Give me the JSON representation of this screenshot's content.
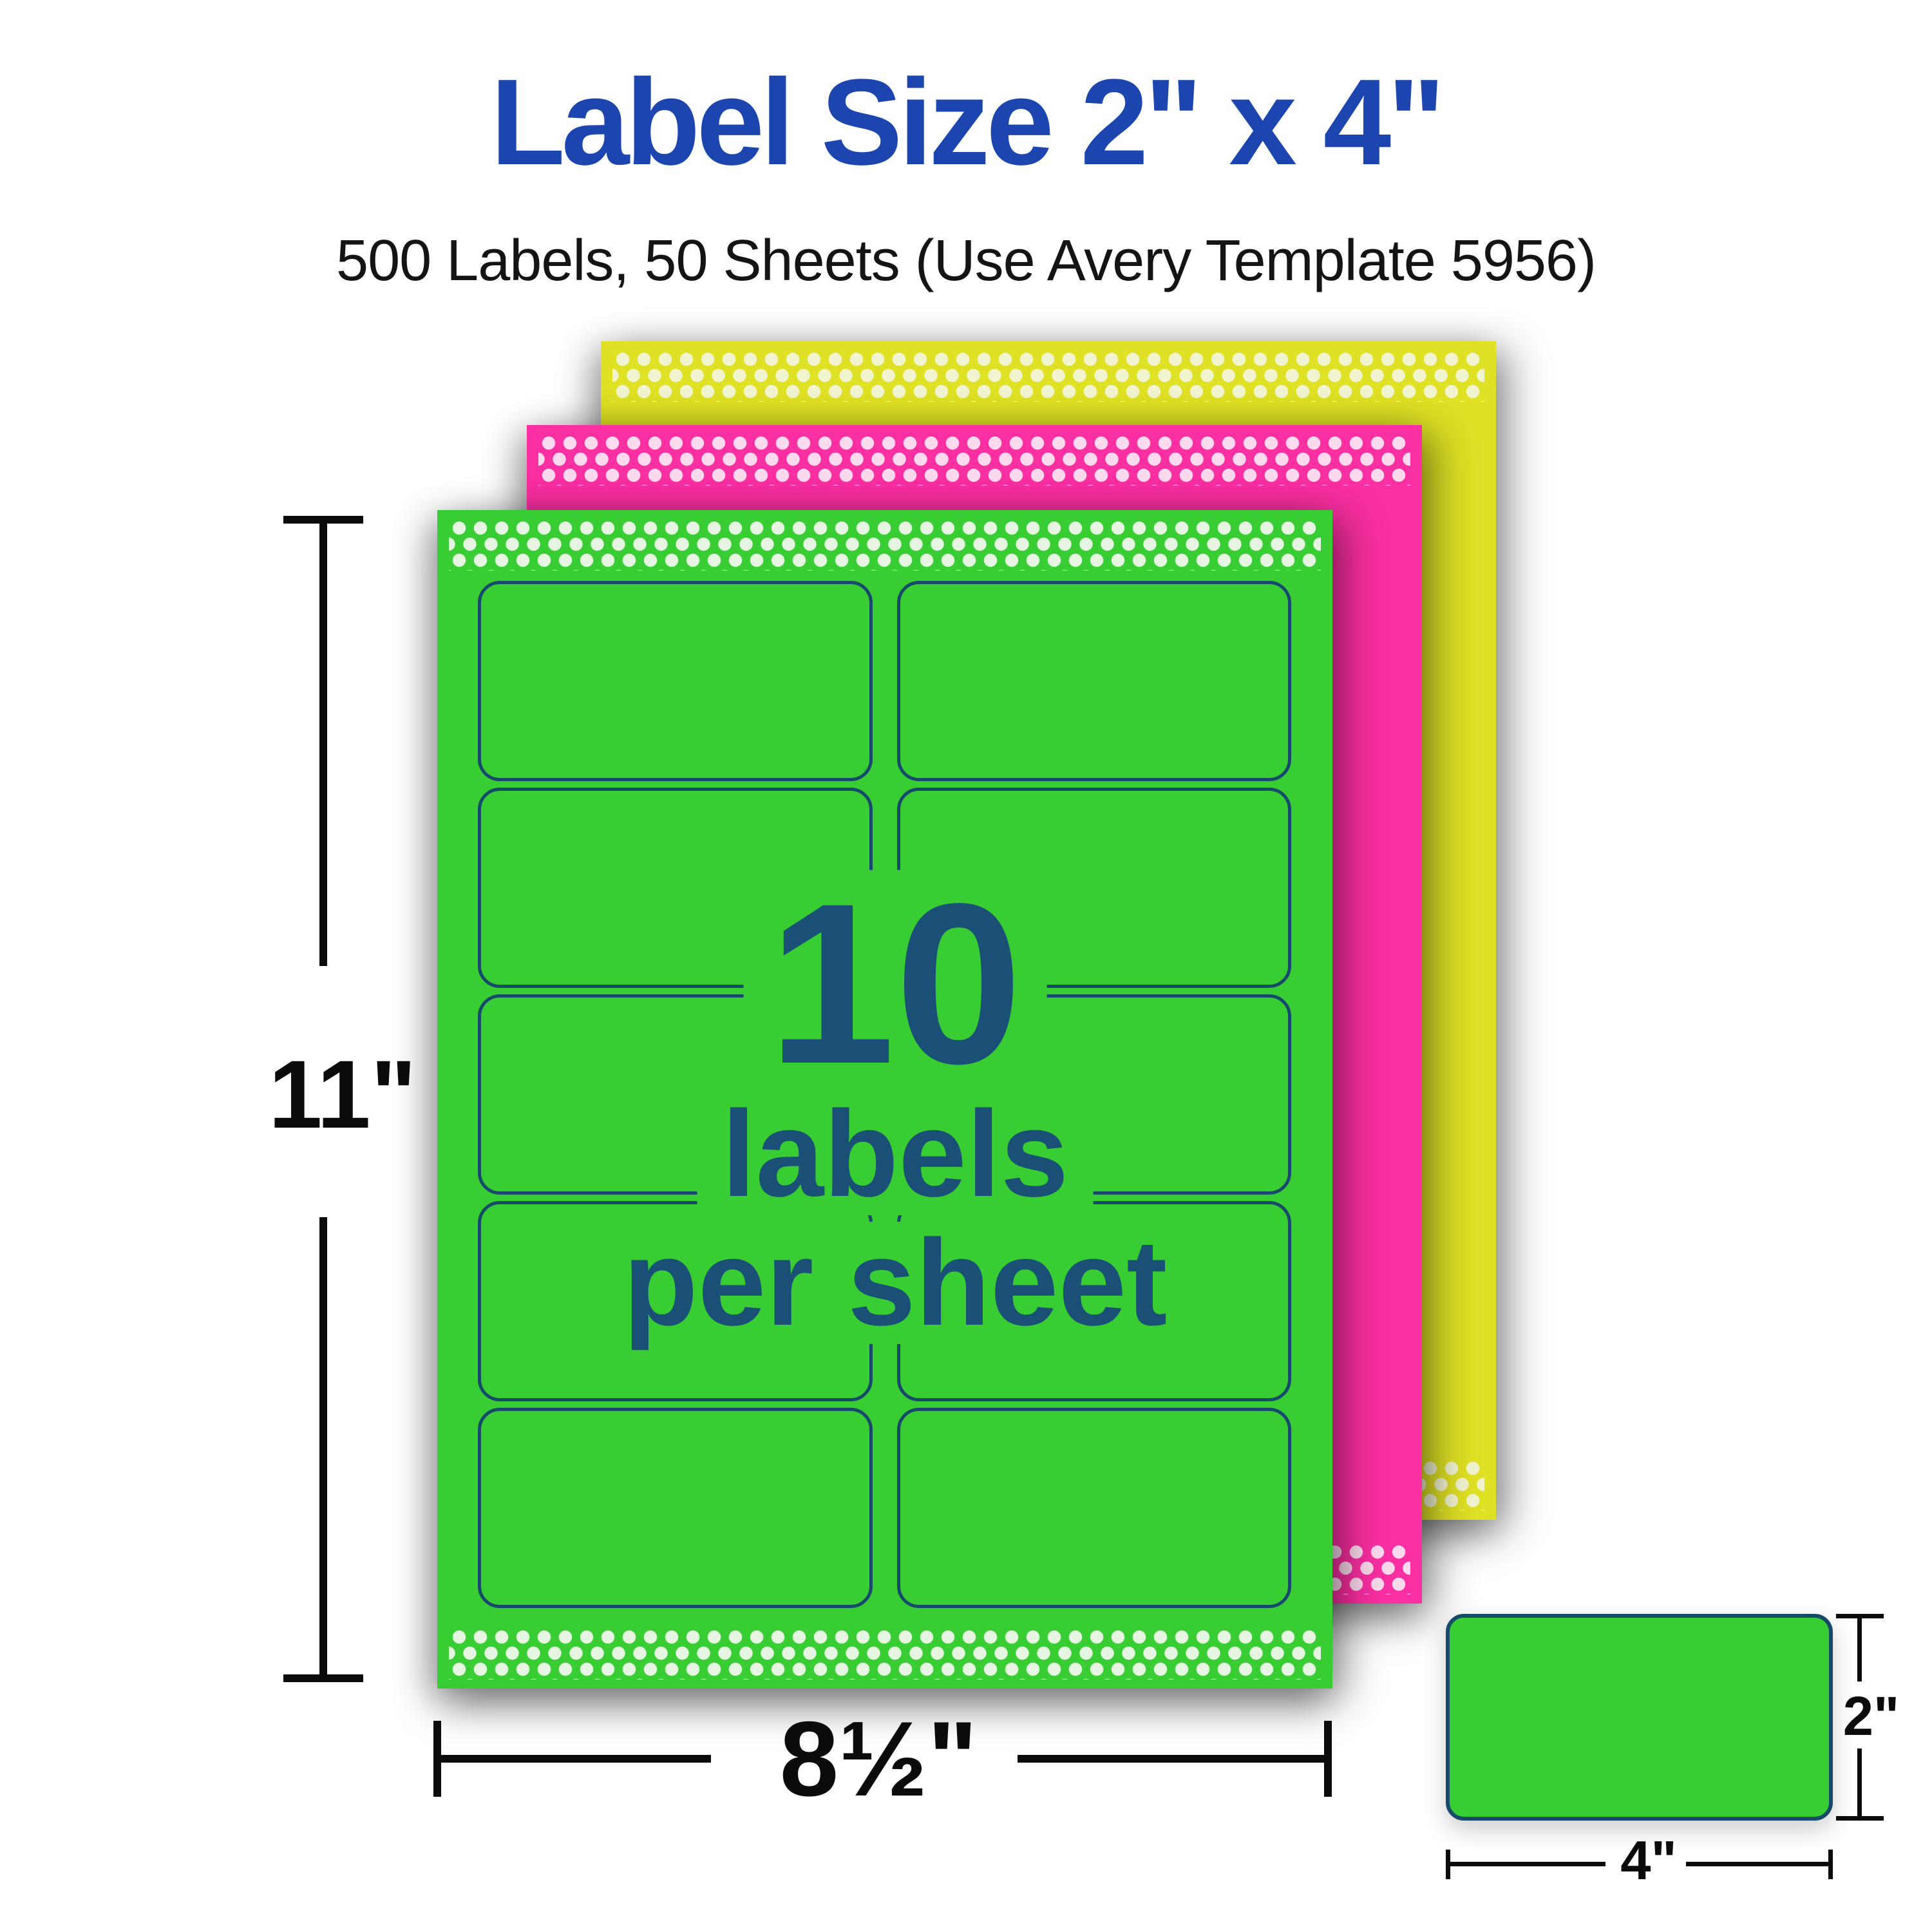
{
  "title": "Label Size 2\" x 4\"",
  "subtitle": "500 Labels, 50 Sheets (Use Avery Template 5956)",
  "sheet_overlay": {
    "count": "10",
    "unit_line1": "labels",
    "unit_line2": "per sheet"
  },
  "dimensions": {
    "sheet_height": "11\"",
    "sheet_width": "8½\"",
    "label_height": "2\"",
    "label_width": "4\""
  },
  "sheet": {
    "labels_per_sheet": 10,
    "columns": 2,
    "rows": 5,
    "template_number": "5956"
  },
  "colors": {
    "title_blue": "#1c45b0",
    "subtitle_black": "#141414",
    "text_navy": "#1a5075",
    "outline_navy": "#17496b",
    "green": "#38cd33",
    "green_dot": "#e5f5e1",
    "pink": "#fa2fa2",
    "pink_dot": "#fcd9ec",
    "yellow": "#dfe125",
    "yellow_dot": "#f2f4d0",
    "dim_black": "#0b0b0b"
  }
}
